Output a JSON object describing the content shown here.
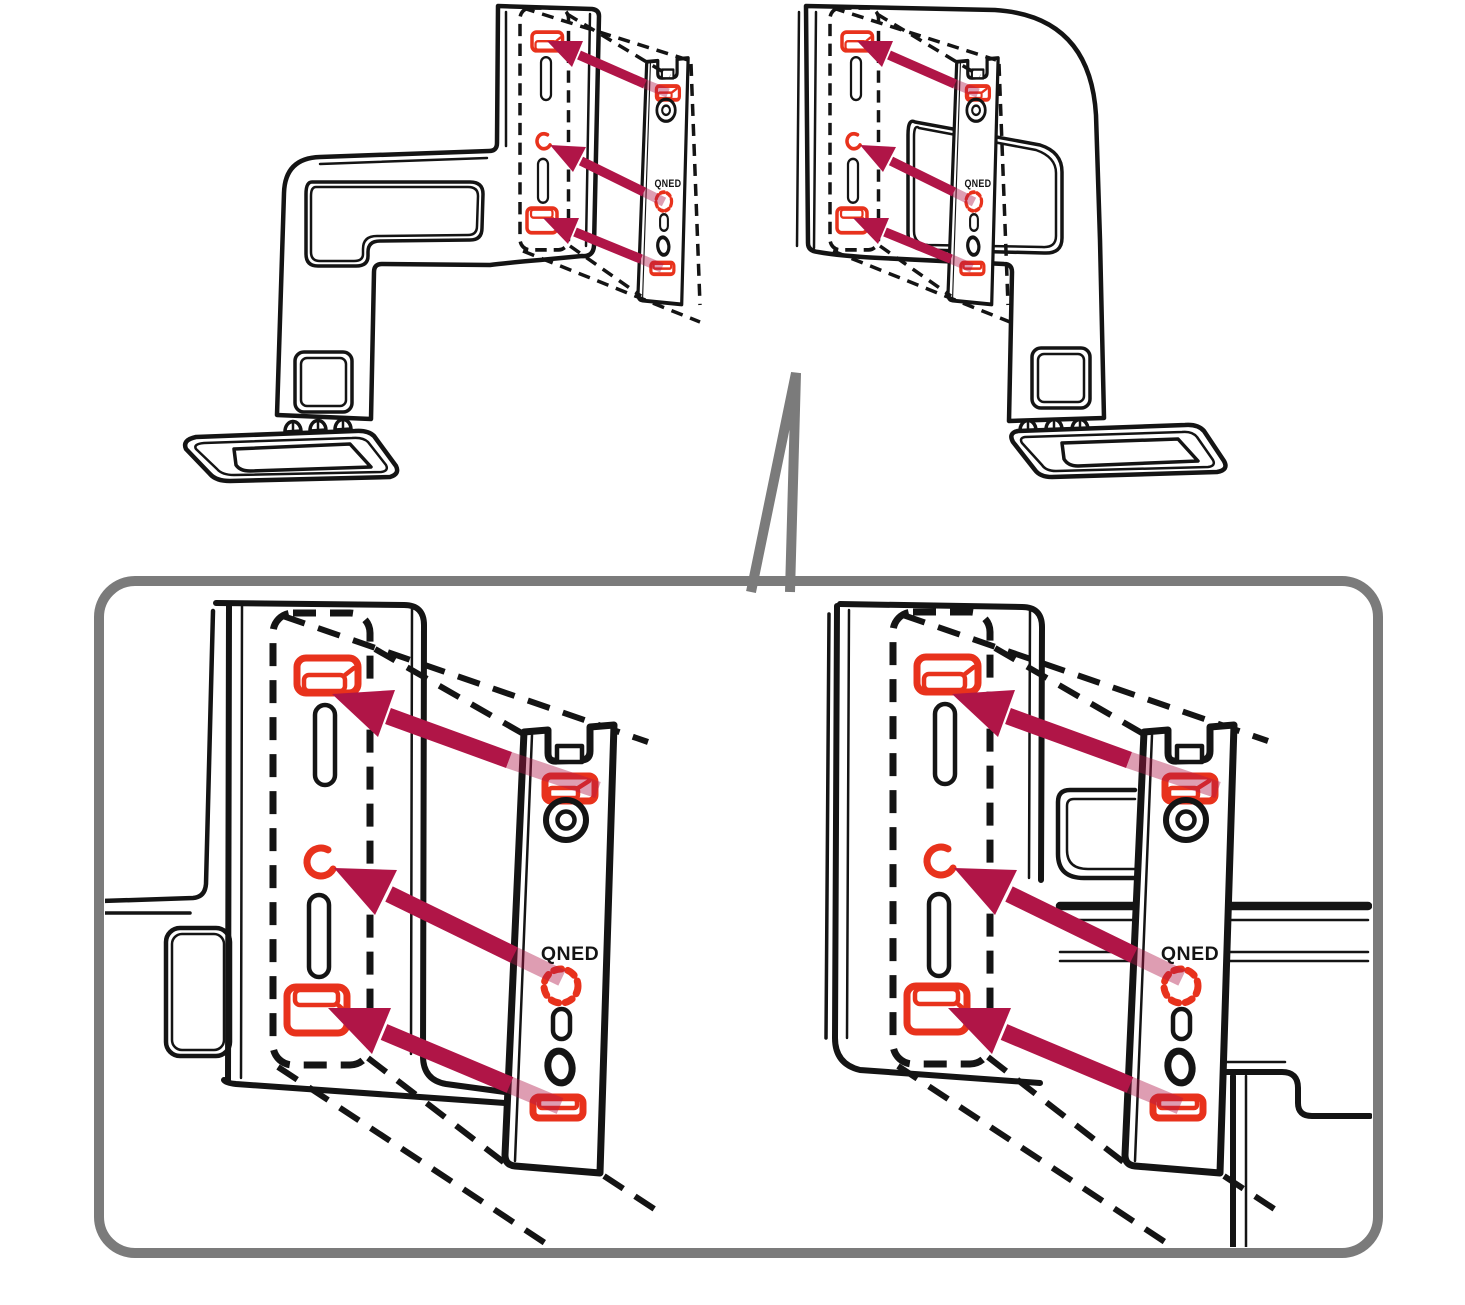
{
  "diagram": {
    "title": "stand-bracket-assembly-diagram",
    "qned_label": "QNED",
    "colors": {
      "outline_black": "#141414",
      "highlight_red": "#e8321c",
      "arrow_crimson": "#b01547",
      "callout_border_gray": "#7b7b7b",
      "background": "#ffffff"
    },
    "views": {
      "top_left": "left-stand-with-bracket-attachment",
      "top_right": "right-stand-with-bracket-attachment",
      "detail_left": "left-attachment-magnified",
      "detail_right": "right-attachment-magnified"
    },
    "marker_counts": {
      "red_slots_per_view": 3,
      "arrows_per_view": 3
    }
  }
}
